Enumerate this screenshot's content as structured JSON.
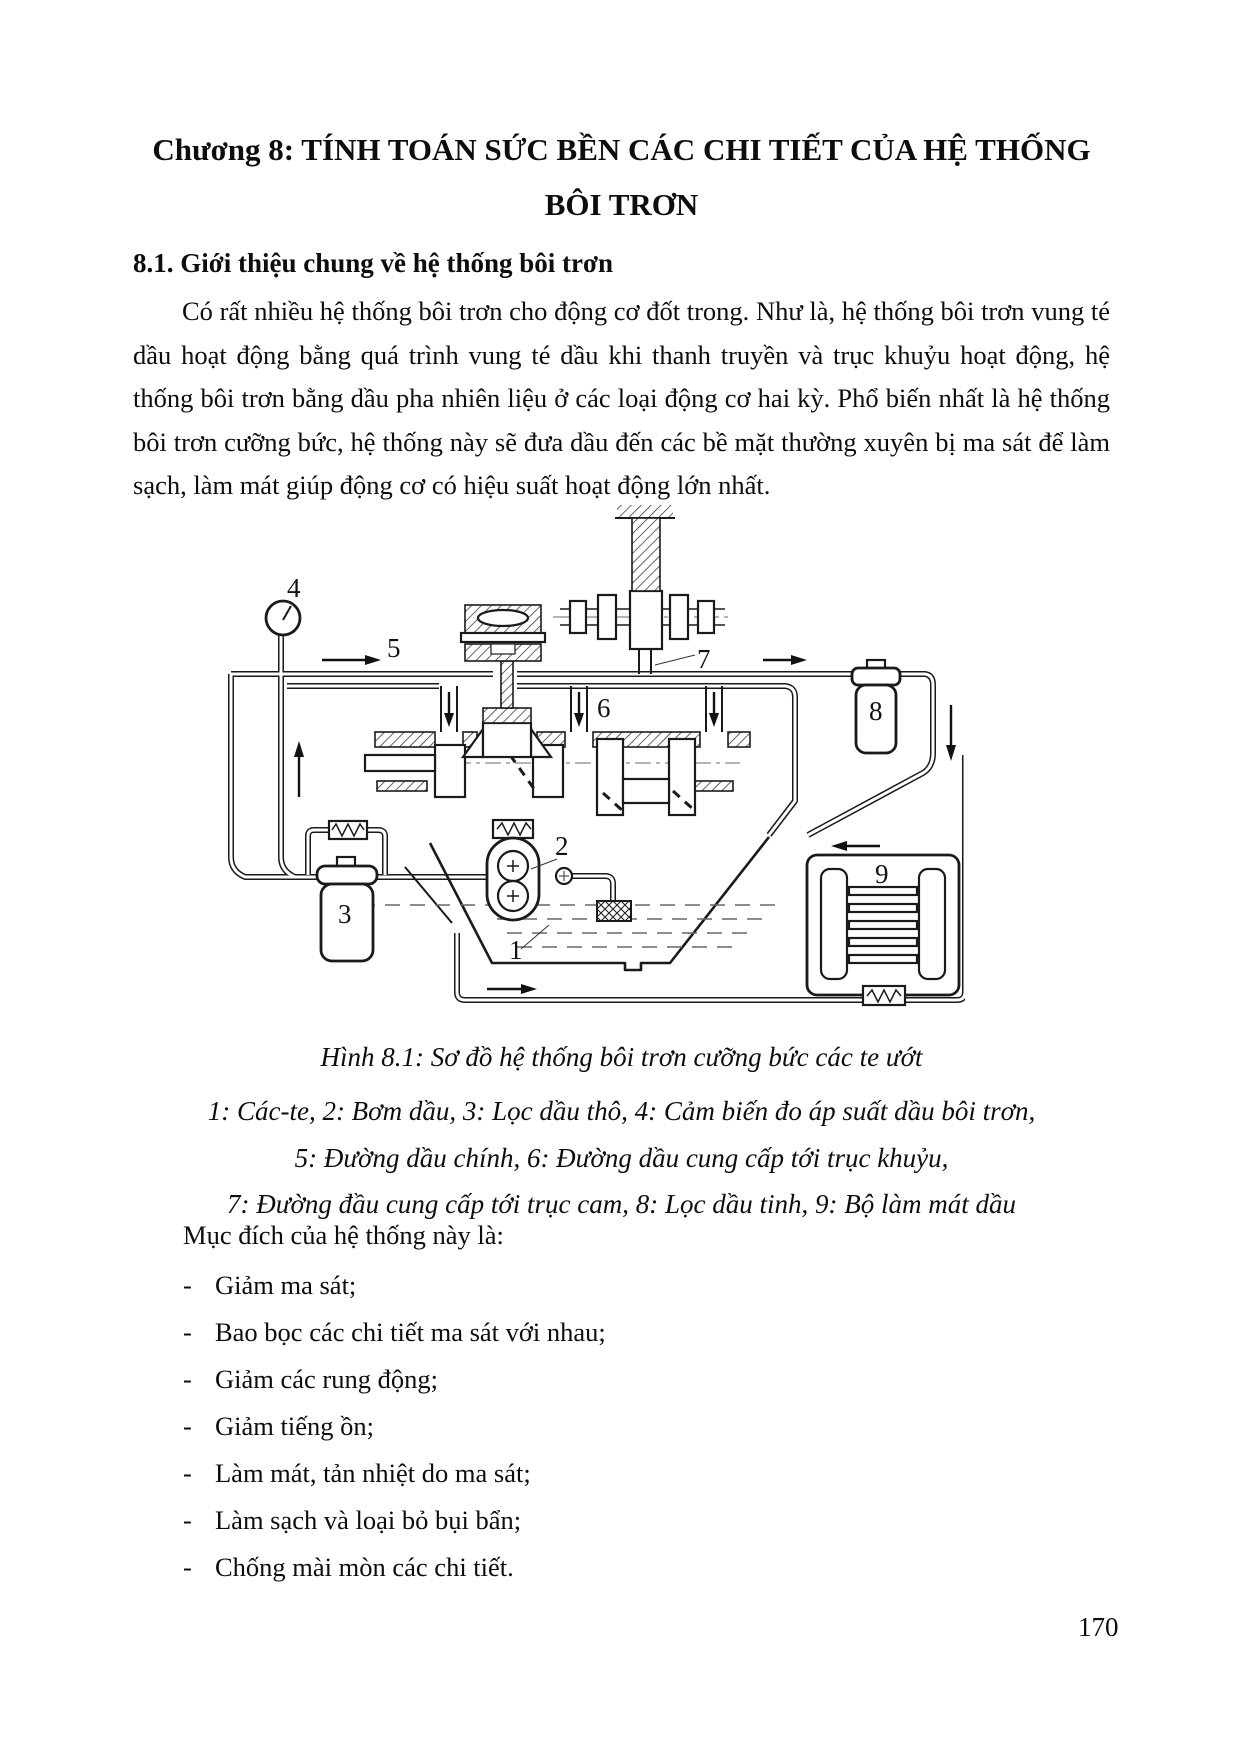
{
  "title": {
    "line1": "Chương 8: TÍNH TOÁN SỨC BỀN CÁC CHI TIẾT CỦA HỆ THỐNG",
    "line2": "BÔI TRƠN"
  },
  "section": {
    "heading": "8.1. Giới thiệu chung về hệ thống bôi trơn",
    "paragraph": "Có rất nhiều hệ thống bôi trơn cho động cơ đốt trong. Như là, hệ thống bôi trơn vung té dầu hoạt động bằng quá trình vung té dầu khi thanh truyền và trục khuỷu hoạt động, hệ thống bôi trơn bằng dầu pha nhiên liệu ở các loại động cơ hai kỳ. Phổ biến nhất là hệ thống bôi trơn cưỡng bức, hệ thống này sẽ đưa dầu đến các bề mặt thường xuyên bị ma sát để làm sạch, làm mát giúp động cơ có hiệu suất hoạt động lớn nhất."
  },
  "figure": {
    "caption": "Hình 8.1: Sơ đồ hệ thống bôi trơn cưỡng bức các te ướt",
    "legend": [
      "1: Các-te, 2: Bơm dầu, 3: Lọc dầu thô, 4: Cảm biến đo áp suất dầu bôi trơn,",
      "5: Đường dầu chính, 6: Đường dầu cung cấp tới trục khuỷu,",
      "7: Đường đầu cung cấp tới trục cam, 8: Lọc dầu tinh, 9: Bộ làm mát dầu"
    ],
    "labels": {
      "n1": "1",
      "n2": "2",
      "n3": "3",
      "n4": "4",
      "n5": "5",
      "n6": "6",
      "n7": "7",
      "n8": "8",
      "n9": "9"
    }
  },
  "purpose": {
    "intro": "Mục đích của hệ thống này là:",
    "dash": "-",
    "bullets": [
      "Giảm ma sát;",
      "Bao bọc các chi tiết ma sát với nhau;",
      "Giảm các rung động;",
      "Giảm tiếng ồn;",
      "Làm mát, tản nhiệt do ma sát;",
      "Làm sạch và loại bỏ bụi bẩn;",
      "Chống mài mòn các chi tiết."
    ]
  },
  "page": {
    "number": "170"
  }
}
